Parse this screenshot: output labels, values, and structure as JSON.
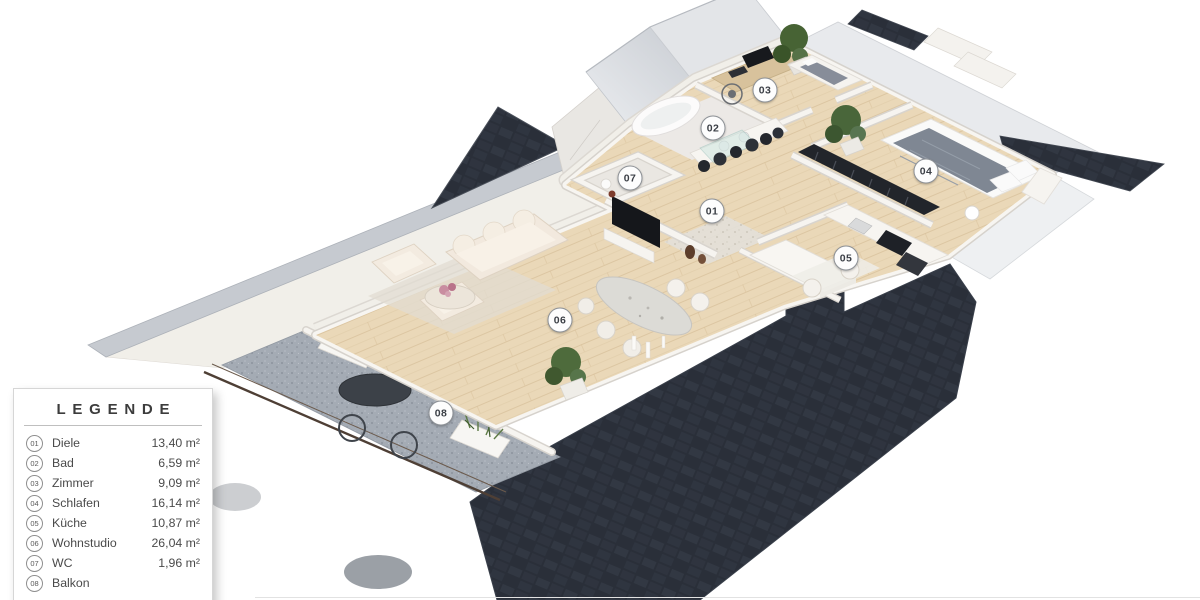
{
  "legend": {
    "title": "LEGENDE",
    "items": [
      {
        "num": "01",
        "name": "Diele",
        "area": "13,40 m²"
      },
      {
        "num": "02",
        "name": "Bad",
        "area": "6,59 m²"
      },
      {
        "num": "03",
        "name": "Zimmer",
        "area": "9,09 m²"
      },
      {
        "num": "04",
        "name": "Schlafen",
        "area": "16,14 m²"
      },
      {
        "num": "05",
        "name": "Küche",
        "area": "10,87 m²"
      },
      {
        "num": "06",
        "name": "Wohnstudio",
        "area": "26,04 m²"
      },
      {
        "num": "07",
        "name": "WC",
        "area": "1,96 m²"
      },
      {
        "num": "08",
        "name": "Balkon",
        "area": ""
      }
    ]
  },
  "markers": [
    {
      "label": "01",
      "x": 712,
      "y": 211
    },
    {
      "label": "02",
      "x": 713,
      "y": 128
    },
    {
      "label": "03",
      "x": 765,
      "y": 90
    },
    {
      "label": "04",
      "x": 926,
      "y": 171
    },
    {
      "label": "05",
      "x": 846,
      "y": 258
    },
    {
      "label": "06",
      "x": 560,
      "y": 320
    },
    {
      "label": "07",
      "x": 630,
      "y": 178
    },
    {
      "label": "08",
      "x": 441,
      "y": 413
    }
  ],
  "colors": {
    "roof_dark": "#2a2f39",
    "roof_tile": "#3d434f",
    "eave": "#c6cad0",
    "wood": "#ead8b8",
    "wood_dark": "#d7c09a",
    "wall": "#f6f4f0",
    "wall_edge": "#d8d4cd",
    "balcony": "#a4abb4",
    "balcony_speck": "#868d97",
    "sofa": "#f2e9de",
    "bed": "#7f8793",
    "plant": "#4e6b3c",
    "marker_border": "#8e9297",
    "marker_text": "#3b3f46",
    "legend_text": "#4a4a4a"
  }
}
